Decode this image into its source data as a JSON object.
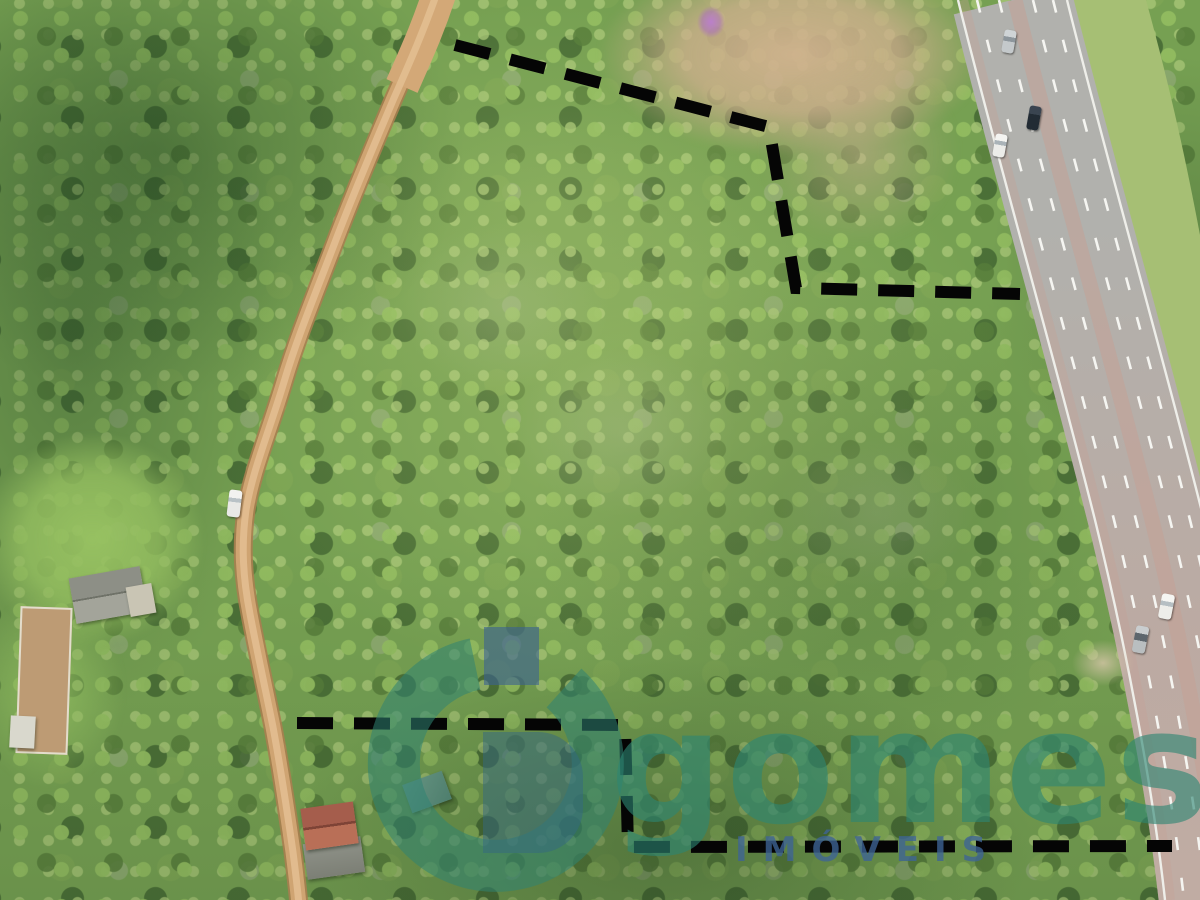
{
  "scene": {
    "kind": "aerial-drone-photograph",
    "description": "Top-down drone photo of a forested land parcel marked with a black dashed property boundary, bordered by a winding dirt road on the left and a multi-lane highway on the right, with a tan clearing at top, grass fields and small rural buildings on the left, and a real-estate watermark.",
    "boundary": {
      "style": "dashed",
      "color": "#000000"
    },
    "watermark": {
      "brand": "gomes",
      "subtitle": "IMÓVEIS",
      "brand_color": "#2d8672",
      "subtitle_color": "#3e6496",
      "logo": "g-circle-monogram"
    },
    "features": {
      "dirt_road": "winding tan dirt road on the left",
      "highway": "six-lane highway running diagonally on the right",
      "grass_verge": "mowed grass strip east of the highway (top right)",
      "clearings": [
        "tan dirt clearing top-center",
        "grass field left-center"
      ],
      "buildings": [
        "gray-roof house",
        "fenced dirt paddock",
        "white shed",
        "red-roof house with gray annex",
        "teal-roof shed"
      ],
      "vehicles_on_highway": 5,
      "vehicles_on_dirt_road": 1,
      "flowering_tree_color": "#ba7dce"
    }
  }
}
